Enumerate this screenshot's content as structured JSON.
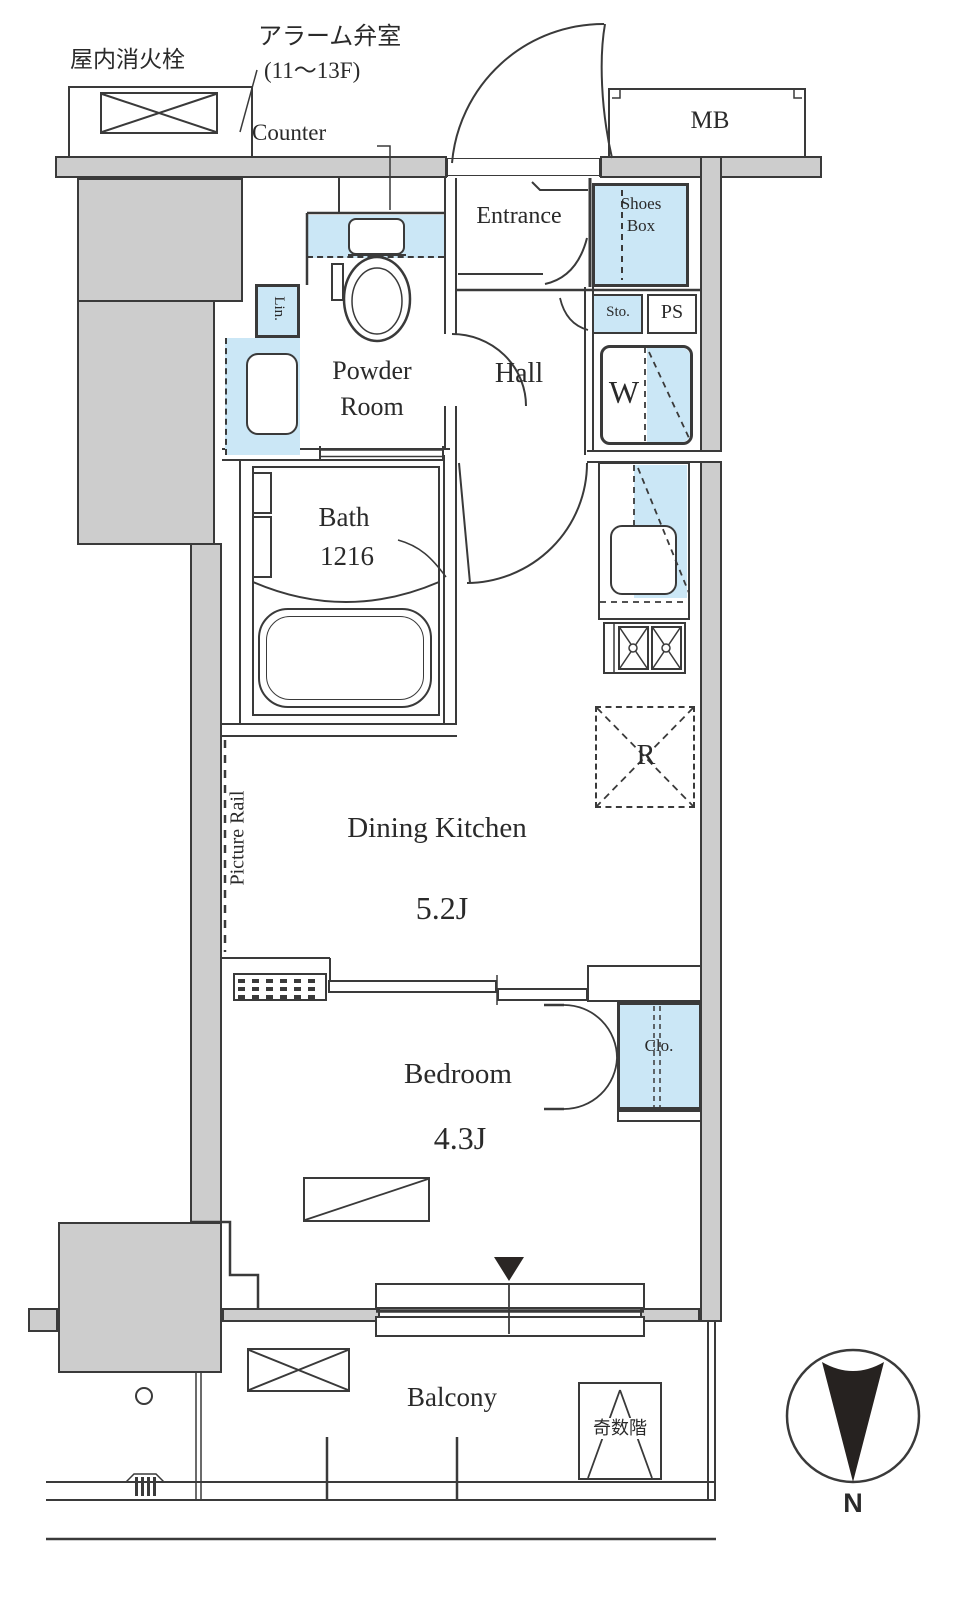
{
  "labels": {
    "fire_hydrant": "屋内消火栓",
    "alarm_valve_line1": "アラーム弁室",
    "alarm_valve_line2": "(11～13F)",
    "counter": "Counter",
    "meter_box": "MB",
    "entrance": "Entrance",
    "shoes_box_line1": "Shoes",
    "shoes_box_line2": "Box",
    "storage": "Sto.",
    "pipe_space": "PS",
    "powder_room_line1": "Powder",
    "powder_room_line2": "Room",
    "linen": "Lin.",
    "hall": "Hall",
    "washer": "W",
    "bath_line1": "Bath",
    "bath_line2": "1216",
    "refrigerator": "R",
    "dining_kitchen_name": "Dining Kitchen",
    "dining_kitchen_size": "5.2J",
    "picture_rail": "Picture Rail",
    "bedroom_name": "Bedroom",
    "bedroom_size": "4.3J",
    "closet": "Clo.",
    "balcony": "Balcony",
    "odd_floors": "奇数階",
    "compass_north": "N"
  },
  "colors": {
    "fixture_blue": "#cbe7f6",
    "wall_gray": "#cdcdcd",
    "line_dark": "#3a3a3a"
  }
}
